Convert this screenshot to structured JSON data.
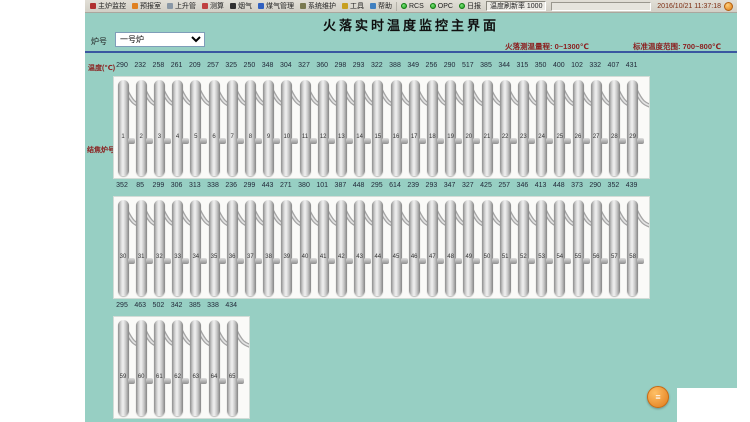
{
  "window": {
    "datetime": "2016/10/21 11:37:18"
  },
  "toolbar": {
    "items": [
      {
        "label": "主炉监控",
        "icon": "main-monitor-icon",
        "color": "#b03030"
      },
      {
        "label": "预报室",
        "icon": "forecast-icon",
        "color": "#e08020"
      },
      {
        "label": "上升管",
        "icon": "riser-pipe-icon",
        "color": "#8a98a6"
      },
      {
        "label": "测算",
        "icon": "calculate-icon",
        "color": "#c04040"
      },
      {
        "label": "烟气",
        "icon": "flue-gas-icon",
        "color": "#303030"
      },
      {
        "label": "煤气管理",
        "icon": "gas-manage-icon",
        "color": "#3060c0"
      },
      {
        "label": "系统维护",
        "icon": "system-maintain-icon",
        "color": "#7a7a50"
      },
      {
        "label": "工具",
        "icon": "tools-icon",
        "color": "#c8a020"
      },
      {
        "label": "帮助",
        "icon": "help-icon",
        "color": "#4080c0"
      }
    ],
    "status": [
      {
        "label": "RCS"
      },
      {
        "label": "OPC"
      },
      {
        "label": "日报"
      }
    ],
    "refresh": "温度刷新率 1000"
  },
  "header": {
    "title": "火落实时温度监控主界面",
    "range": "火落测温量程: 0~1300℃",
    "standard": "标准温度范围: 700~800℃"
  },
  "controls": {
    "furnace_label": "炉号",
    "furnace_value": "一号炉"
  },
  "labels": {
    "temp_axis": "温度(℃)",
    "oven_axis": "结焦炉号"
  },
  "accent_colors": {
    "background": "#97cfc3",
    "alarm_text": "#8b2020",
    "divider": "#3a57a0"
  },
  "floating_button": {
    "glyph": "≡"
  },
  "rows": [
    {
      "ovens": [
        1,
        2,
        3,
        4,
        5,
        6,
        7,
        8,
        9,
        10,
        11,
        12,
        13,
        14,
        15,
        16,
        17,
        18,
        19,
        20,
        21,
        22,
        23,
        24,
        25,
        26,
        27,
        28,
        29
      ],
      "temps": [
        290,
        232,
        258,
        261,
        209,
        257,
        325,
        250,
        348,
        304,
        327,
        360,
        298,
        293,
        322,
        388,
        349,
        256,
        290,
        517,
        385,
        344,
        315,
        350,
        400,
        102,
        332,
        407,
        431
      ]
    },
    {
      "ovens": [
        30,
        31,
        32,
        33,
        34,
        35,
        36,
        37,
        38,
        39,
        40,
        41,
        42,
        43,
        44,
        45,
        46,
        47,
        48,
        49,
        50,
        51,
        52,
        53,
        54,
        55,
        56,
        57,
        58
      ],
      "temps": [
        352,
        85,
        299,
        306,
        313,
        338,
        236,
        299,
        443,
        271,
        380,
        101,
        387,
        448,
        295,
        614,
        239,
        293,
        347,
        327,
        425,
        257,
        346,
        413,
        448,
        373,
        290,
        352,
        439
      ]
    },
    {
      "ovens": [
        59,
        60,
        61,
        62,
        63,
        64,
        65
      ],
      "temps": [
        295,
        463,
        502,
        342,
        385,
        338,
        434
      ]
    }
  ]
}
